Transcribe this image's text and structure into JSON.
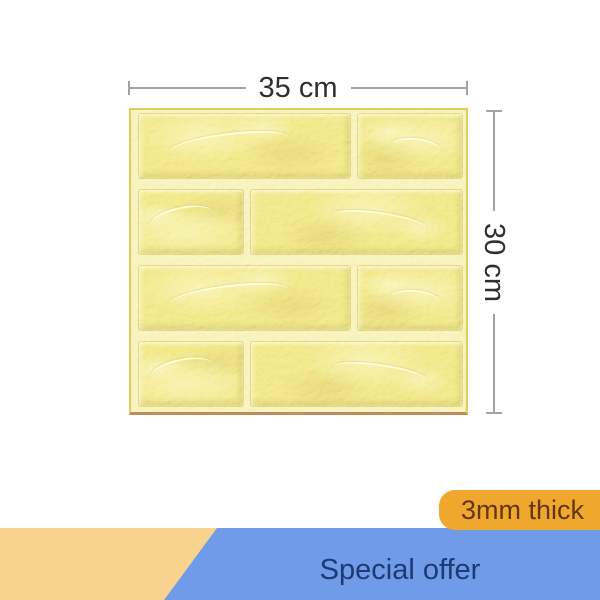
{
  "dimensions": {
    "width_label": "35 cm",
    "height_label": "30 cm"
  },
  "badge": {
    "label": "3mm thick"
  },
  "banner": {
    "label": "Special offer"
  },
  "panel": {
    "rows": [
      [
        "wide",
        "narrow"
      ],
      [
        "narrow",
        "wide"
      ],
      [
        "wide",
        "narrow"
      ],
      [
        "narrow",
        "wide"
      ]
    ]
  },
  "colors": {
    "page_bg": "#FFFFFF",
    "brick": "#EDE06A",
    "mortar": "#F4EEA8",
    "panel_border": "#E0CD5E",
    "panel_edge": "#BF8C5A",
    "dim_line": "#A3A3A3",
    "dim_text": "#2F2F2F",
    "badge_bg": "#F0A72E",
    "badge_text": "#633712",
    "banner_bg": "#6F9BE8",
    "banner_text": "#1D3B72",
    "ribbon_bg": "#F8D28F"
  }
}
